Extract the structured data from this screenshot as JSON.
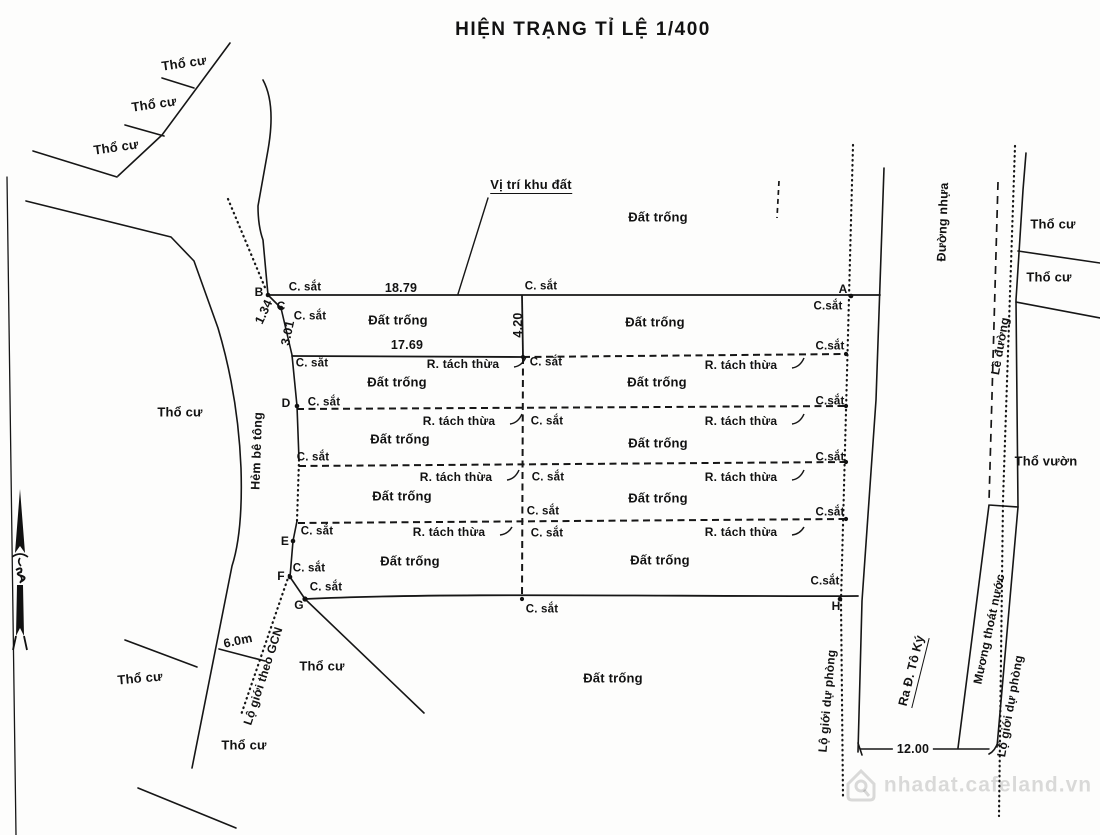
{
  "title": "HIỆN TRẠNG TỈ LỆ 1/400",
  "map": {
    "groups": {
      "areas": {
        "dn": "area-label",
        "fs": 13,
        "items": [
          {
            "t": "Thổ cư",
            "x": 184,
            "y": 63,
            "r": -8
          },
          {
            "t": "Thổ cư",
            "x": 154,
            "y": 104,
            "r": -8
          },
          {
            "t": "Thổ cư",
            "x": 116,
            "y": 147,
            "r": -8
          },
          {
            "t": "Thổ cư",
            "x": 180,
            "y": 412
          },
          {
            "t": "Thổ cư",
            "x": 140,
            "y": 678,
            "r": -5
          },
          {
            "t": "Thổ cư",
            "x": 322,
            "y": 666
          },
          {
            "t": "Thổ cư",
            "x": 244,
            "y": 745
          },
          {
            "t": "Thổ cư",
            "x": 1053,
            "y": 224
          },
          {
            "t": "Thổ cư",
            "x": 1049,
            "y": 277
          },
          {
            "t": "Thổ vườn",
            "x": 1046,
            "y": 461,
            "n": "tho-vuon-label"
          },
          {
            "t": "Đất trống",
            "x": 658,
            "y": 217
          },
          {
            "t": "Đất trống",
            "x": 398,
            "y": 320
          },
          {
            "t": "Đất trống",
            "x": 655,
            "y": 322
          },
          {
            "t": "Đất trống",
            "x": 397,
            "y": 382
          },
          {
            "t": "Đất trống",
            "x": 657,
            "y": 382
          },
          {
            "t": "Đất trống",
            "x": 400,
            "y": 439
          },
          {
            "t": "Đất trống",
            "x": 658,
            "y": 443
          },
          {
            "t": "Đất trống",
            "x": 402,
            "y": 496
          },
          {
            "t": "Đất trống",
            "x": 658,
            "y": 498
          },
          {
            "t": "Đất trống",
            "x": 410,
            "y": 561
          },
          {
            "t": "Đất trống",
            "x": 660,
            "y": 560
          },
          {
            "t": "Đất trống",
            "x": 613,
            "y": 678
          },
          {
            "t": "Vị trí khu đất",
            "x": 531,
            "y": 186,
            "u": true,
            "n": "site-location-label"
          }
        ]
      },
      "roads": {
        "dn": "road-label",
        "fs": 12.5,
        "items": [
          {
            "t": "Đường nhựa",
            "x": 943,
            "y": 222,
            "r": -88,
            "n": "asphalt-road-label"
          },
          {
            "t": "Lề đường",
            "x": 1000,
            "y": 346,
            "r": -80,
            "fs": 12,
            "n": "road-shoulder-label"
          },
          {
            "t": "Mương thoát nước",
            "x": 989,
            "y": 629,
            "r": -78,
            "fs": 12,
            "n": "drainage-ditch-label"
          },
          {
            "t": "Lộ giới dự phòng",
            "x": 1010,
            "y": 706,
            "r": -80,
            "fs": 12,
            "n": "reserve-road-boundary-label"
          },
          {
            "t": "Lộ giới dự phòng",
            "x": 827,
            "y": 701,
            "r": -85,
            "fs": 12,
            "n": "reserve-road-boundary-label"
          },
          {
            "t": "Ra Đ. Tô Ký",
            "x": 913,
            "y": 671,
            "r": -76,
            "u": true,
            "n": "to-toky-street-label"
          },
          {
            "t": "Hẻm bê tông",
            "x": 257,
            "y": 451,
            "r": -88,
            "n": "concrete-alley-label"
          },
          {
            "t": "Lộ giới theo GCN",
            "x": 263,
            "y": 676,
            "r": -72,
            "fs": 12,
            "n": "gcn-road-boundary-label"
          }
        ]
      },
      "fences": {
        "dn": "iron-fence-marker-label",
        "fs": 11.5,
        "items": [
          {
            "t": "C. sắt",
            "x": 305,
            "y": 288
          },
          {
            "t": "C. sắt",
            "x": 310,
            "y": 317
          },
          {
            "t": "C. sắt",
            "x": 312,
            "y": 364
          },
          {
            "t": "C. sắt",
            "x": 324,
            "y": 403
          },
          {
            "t": "C. sắt",
            "x": 313,
            "y": 458
          },
          {
            "t": "C. sắt",
            "x": 317,
            "y": 532
          },
          {
            "t": "C. sắt",
            "x": 309,
            "y": 569
          },
          {
            "t": "C. sắt",
            "x": 326,
            "y": 588
          },
          {
            "t": "C. sắt",
            "x": 541,
            "y": 287
          },
          {
            "t": "C. sắt",
            "x": 546,
            "y": 363
          },
          {
            "t": "C. sắt",
            "x": 547,
            "y": 422
          },
          {
            "t": "C. sắt",
            "x": 548,
            "y": 478
          },
          {
            "t": "C. sắt",
            "x": 543,
            "y": 512
          },
          {
            "t": "C. sắt",
            "x": 547,
            "y": 534
          },
          {
            "t": "C. sắt",
            "x": 542,
            "y": 610
          },
          {
            "t": "C.sắt",
            "x": 828,
            "y": 307
          },
          {
            "t": "C.sắt",
            "x": 830,
            "y": 347
          },
          {
            "t": "C.sắt",
            "x": 830,
            "y": 402
          },
          {
            "t": "C.sắt",
            "x": 830,
            "y": 458
          },
          {
            "t": "C.sắt",
            "x": 830,
            "y": 513
          },
          {
            "t": "C.sắt",
            "x": 825,
            "y": 582
          }
        ]
      },
      "splits": {
        "dn": "split-parcel-label",
        "fs": 12,
        "items": [
          {
            "t": "R. tách thừa",
            "x": 463,
            "y": 364
          },
          {
            "t": "R. tách thừa",
            "x": 459,
            "y": 421
          },
          {
            "t": "R. tách thừa",
            "x": 456,
            "y": 477
          },
          {
            "t": "R. tách thừa",
            "x": 449,
            "y": 532
          },
          {
            "t": "R. tách thừa",
            "x": 741,
            "y": 365
          },
          {
            "t": "R. tách thừa",
            "x": 741,
            "y": 421
          },
          {
            "t": "R. tách thừa",
            "x": 741,
            "y": 477
          },
          {
            "t": "R. tách thừa",
            "x": 741,
            "y": 532
          }
        ]
      },
      "dimensions": {
        "dn": "dimension-label",
        "fs": 12.5,
        "items": [
          {
            "t": "18.79",
            "x": 401,
            "y": 288
          },
          {
            "t": "17.69",
            "x": 407,
            "y": 345
          },
          {
            "t": "4.20",
            "x": 518,
            "y": 325,
            "r": -90
          },
          {
            "t": "3.01",
            "x": 288,
            "y": 333,
            "r": -78
          },
          {
            "t": "1.34",
            "x": 264,
            "y": 312,
            "r": -65
          },
          {
            "t": "6.0m",
            "x": 238,
            "y": 641,
            "r": -12
          },
          {
            "t": "12.00",
            "x": 913,
            "y": 749,
            "bg": true
          }
        ]
      },
      "points": {
        "dn": "survey-point-label",
        "fs": 12,
        "items": [
          {
            "t": "A",
            "x": 843,
            "y": 289
          },
          {
            "t": "B",
            "x": 259,
            "y": 292
          },
          {
            "t": "C",
            "x": 281,
            "y": 306
          },
          {
            "t": "D",
            "x": 286,
            "y": 403
          },
          {
            "t": "E",
            "x": 285,
            "y": 541
          },
          {
            "t": "F",
            "x": 281,
            "y": 576
          },
          {
            "t": "G",
            "x": 299,
            "y": 605
          },
          {
            "t": "H",
            "x": 836,
            "y": 606
          }
        ]
      },
      "watermark": {
        "dn": "watermark-text",
        "fs": 21,
        "items": [
          {
            "t": "nhadat.cafeland.vn",
            "x": 988,
            "y": 785,
            "cls": "wm"
          }
        ]
      }
    }
  }
}
